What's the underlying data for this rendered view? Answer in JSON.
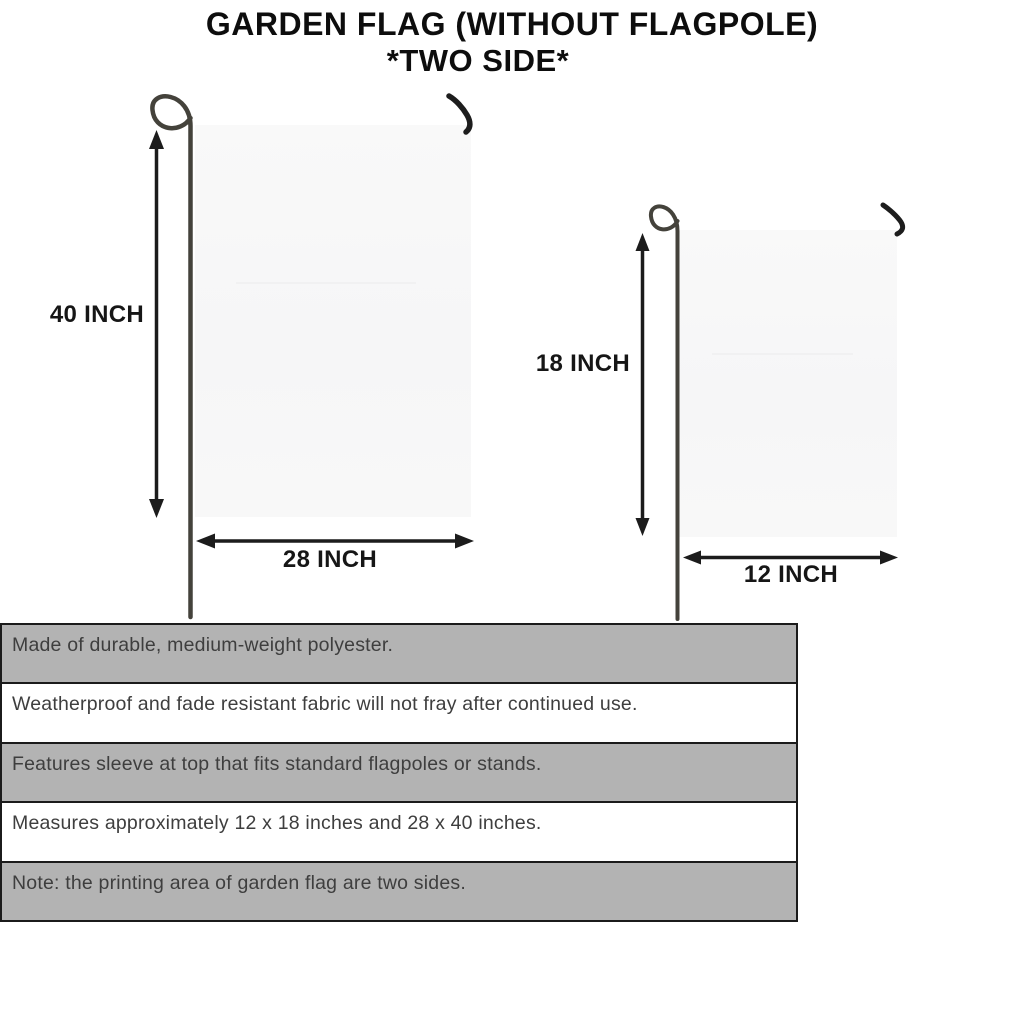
{
  "title": {
    "line1": "GARDEN FLAG (WITHOUT FLAGPOLE)",
    "line2": "*TWO SIDE*"
  },
  "diagram": {
    "large_flag": {
      "height_label": "40 INCH",
      "width_label": "28 INCH"
    },
    "small_flag": {
      "height_label": "18 INCH",
      "width_label": "12 INCH"
    }
  },
  "features": {
    "rows": [
      {
        "text": "Made of durable, medium-weight polyester."
      },
      {
        "text": "Weatherproof and fade resistant fabric will not fray after continued use."
      },
      {
        "text": "Features sleeve at top that fits standard flagpoles or stands."
      },
      {
        "text": "Measures approximately 12 x 18 inches and 28 x 40 inches."
      },
      {
        "text": "Note: the printing area of garden flag are two sides."
      }
    ]
  },
  "icons": {
    "flagpole": "curved-stake-with-loop",
    "hook": "anti-wind-clip-hook",
    "dimension_arrow": "double-headed-arrow"
  },
  "colors": {
    "shaded_row": "#b3b3b3",
    "table_border": "#1b1b1b",
    "flag_fill": "#f7f7f7",
    "pole": "#44423b",
    "ink": "#111111"
  }
}
